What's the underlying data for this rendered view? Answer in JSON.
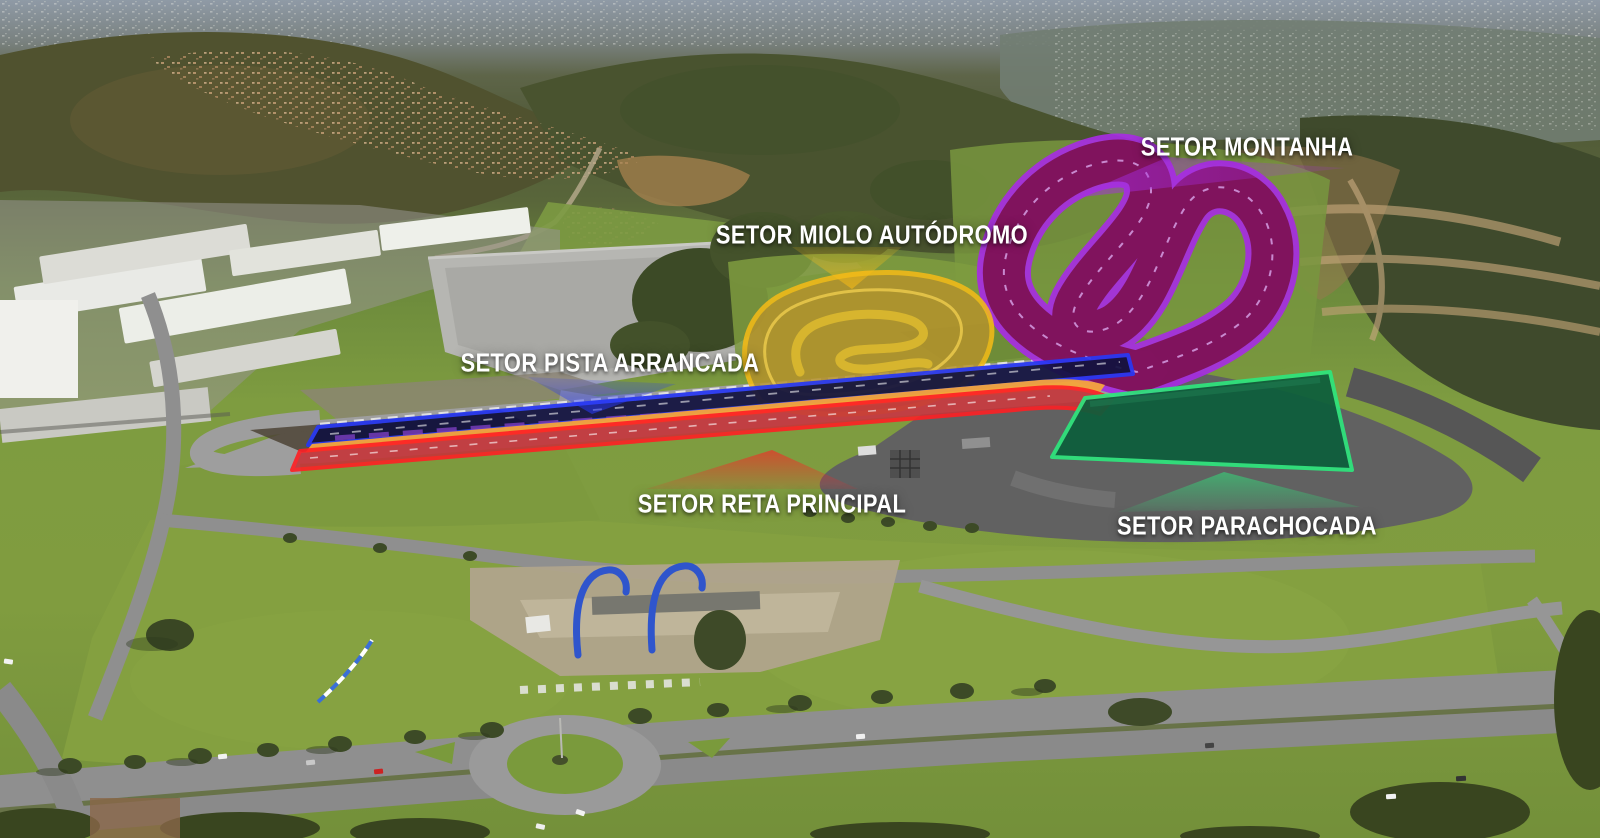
{
  "sectors": [
    {
      "id": "setor-montanha",
      "label": "SETOR MONTANHA",
      "accent": "#a62ce2",
      "fill": "#7e1256"
    },
    {
      "id": "setor-miolo-autodromo",
      "label": "SETOR MIOLO AUTÓDROMO",
      "accent": "#f7bb16",
      "fill": "#b5922c"
    },
    {
      "id": "setor-pista-arrancada",
      "label": "SETOR PISTA ARRANCADA",
      "accent": "#2738f5",
      "fill": "#11123f"
    },
    {
      "id": "setor-reta-principal",
      "label": "SETOR RETA PRINCIPAL",
      "accent": "#ff1f24",
      "fill": "#c5353a",
      "center_stripe": "#f4a43a"
    },
    {
      "id": "setor-parachocada",
      "label": "SETOR PARACHOCADA",
      "accent": "#2ee57c",
      "fill": "#0d5e3c"
    }
  ]
}
